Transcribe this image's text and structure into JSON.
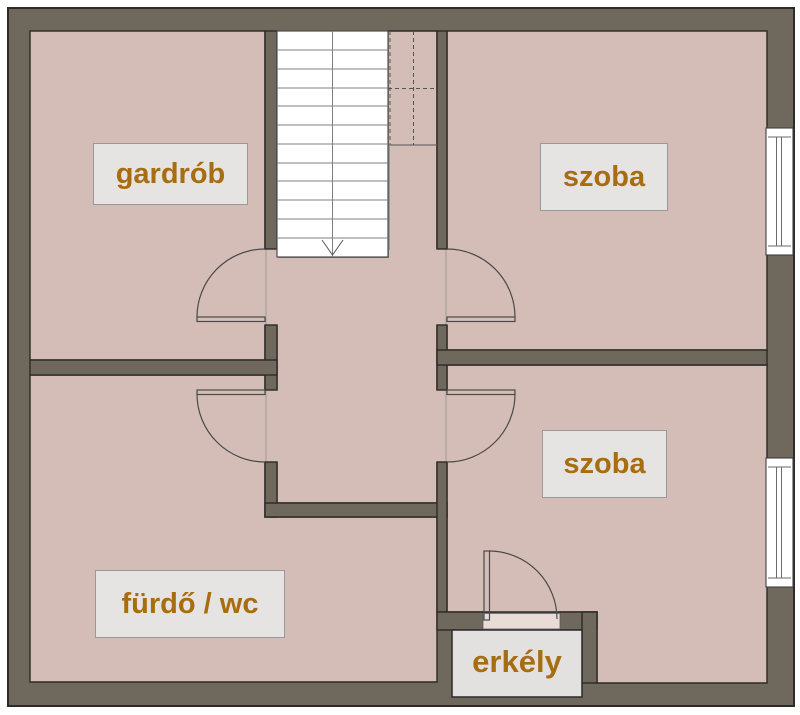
{
  "rooms": [
    {
      "id": "gardrob",
      "label": "gardrób"
    },
    {
      "id": "szoba-top",
      "label": "szoba"
    },
    {
      "id": "szoba-bottom",
      "label": "szoba"
    },
    {
      "id": "furdo-wc",
      "label": "fürdő / wc"
    },
    {
      "id": "erkely",
      "label": "erkély"
    }
  ],
  "stairs": {
    "direction_arrow": "down"
  },
  "colors": {
    "wall": "#6f685c",
    "floor": "#d4bdb6",
    "outline": "#2d2b28",
    "stairs-bg": "#ffffff",
    "stair-line": "#808080",
    "door-line": "#4a4a4a",
    "face-line": "#9a9a9a",
    "label-bg": "#e6e4e2",
    "label-border": "#999999",
    "label-text": "#a86d10",
    "balcony-bg": "#e3e1df",
    "page-bg": "#ffffff"
  }
}
